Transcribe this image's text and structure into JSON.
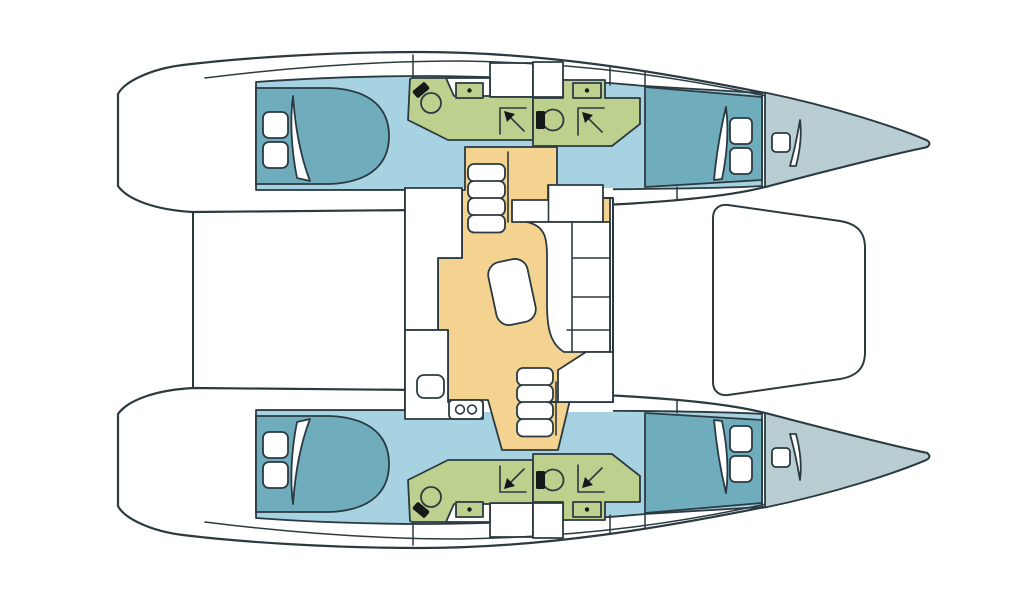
{
  "title": "Catamaran interior layout floor plan (deck plan, bow to the right)",
  "colors": {
    "outline": "#2b3a41",
    "hull_white": "#ffffff",
    "cabin_floor": "#a7d2e2",
    "bed": "#6fadbd",
    "bathroom": "#bdd08e",
    "salon_floor": "#f4d390",
    "bow_deck": "#b9ced3",
    "fixture_dark": "#16181a"
  },
  "vessel": {
    "type": "catamaran",
    "view": "top-down deck plan, bow right, four cabins, two heads per side mirrored",
    "port_hull": {
      "aft_cabin": "double berth with two pillows and door swing",
      "aft_bathroom": "toilet, washbasin with dot drain, shower with corner arrow",
      "forward_bathroom": "toilet, washbasin with dot drain, shower with corner arrow",
      "forward_cabin": "double berth with two pillows and door swing",
      "bow_compartment": "forepeak with hatch and door swing"
    },
    "starboard_hull": {
      "aft_cabin": "double berth with two pillows and door swing",
      "aft_bathroom": "toilet, washbasin with dot drain, shower with corner arrow",
      "forward_bathroom": "toilet, washbasin with dot drain, shower with corner arrow",
      "forward_cabin": "double berth with two pillows and door swing",
      "bow_compartment": "forepeak with hatch and door swing"
    },
    "salon": {
      "galley": "counter with round sink and two-burner stove",
      "dinette": "L-shaped settee with cushions and oval table",
      "companionways": "port and starboard stair flights of four steps",
      "nav_counter": "forward counter block"
    },
    "foredeck": "trampoline between hulls",
    "stern": "twin transom steps joined by aft crossbeam"
  }
}
